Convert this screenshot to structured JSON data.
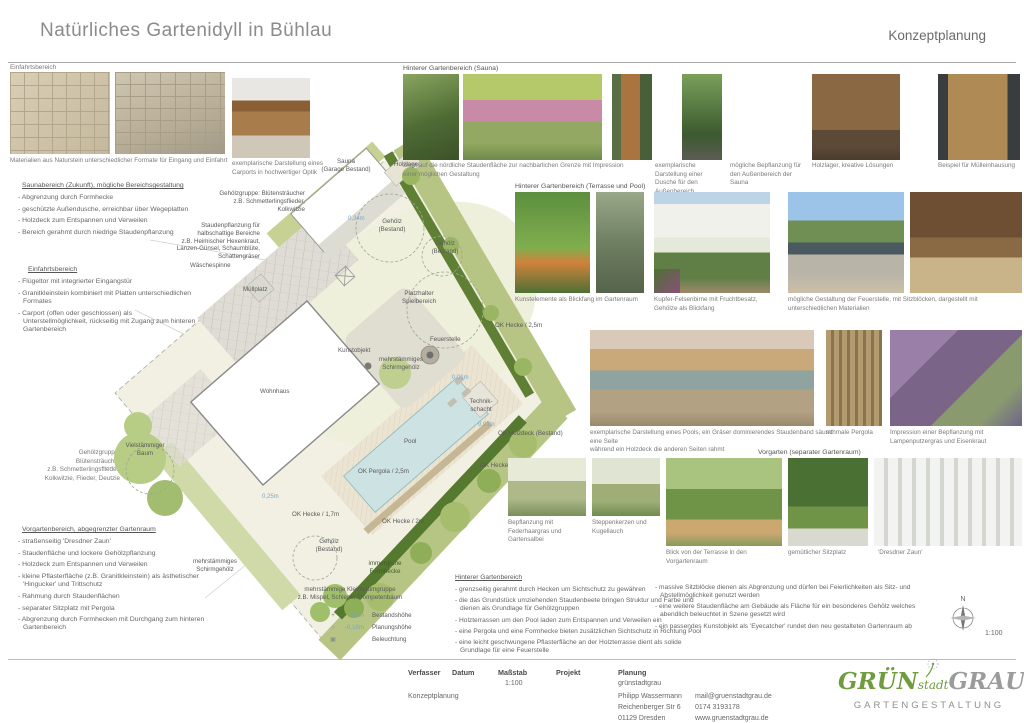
{
  "header": {
    "title": "Natürliches Gartenidyll in Bühlau",
    "doc_type": "Konzeptplanung"
  },
  "left": {
    "einfahrt_label": "Einfahrtsbereich",
    "einfahrt_caption": "Materialien aus Naturstein unterschiedlicher Formate für Eingang und Einfahrt",
    "carport_caption": "exemplarische Darstellung eines Carports in hochwertiger Optik",
    "sauna_heading": "Saunabereich (Zukunft), mögliche Bereichsgestaltung",
    "sauna_items": [
      "- Abgrenzung durch Formhecke",
      "- geschützte Außendusche, erreichbar über Wegeplatten",
      "- Holzdeck zum Entspannen und Verweilen",
      "- Bereich gerahmt durch niedrige Staudenpflanzung"
    ],
    "einfahrt_heading": "Einfahrtsbereich",
    "einfahrt_items": [
      "- Flügeltor mit integrierter Eingangstür",
      "- Granitkleinstein kombiniert mit Platten unterschiedlichen Formates",
      "- Carport (offen oder geschlossen) als Unterstellmöglichkeit, rückseitig mit Zugang zum hinteren Gartenbereich"
    ],
    "gehoelz_note": "Gehölzgruppe: Blütensträucher\nz.B. Schmetterlingsflieder,\nKolkwitzie, Flieder, Deutzie",
    "vorgarten_heading": "Vorgartenbereich, abgegrenzter Gartenraum",
    "vorgarten_items": [
      "- straßenseitig 'Dresdner Zaun'",
      "- Staudenfläche und lockere Gehölzpflanzung",
      "- Holzdeck zum Entspannen und Verweilen",
      "- kleine Pflasterfläche (z.B. Granitkleinstein) als ästhetischer 'Hingucker' und Trittschutz",
      "- Rahmung durch Staudenflächen",
      "- separater Sitzplatz mit Pergola",
      "- Abgrenzung durch Formhecken mit Durchgang zum hinteren Gartenbereich"
    ]
  },
  "plan": {
    "labels": {
      "sauna": "Sauna\n(Garage Bestand)",
      "holzlager": "Holzlager",
      "gehoelzgruppe": "Gehölzgruppe: Blütensträucher\nz.B. Schmetterlingsflieder,\nKolkwitzie",
      "stauden": "Staudenpflanzung für\nhalbschattige Bereiche\nz.B. Heimischer Hexenkraut,\nLanzen-Günsel, Schaumblüte,\nSchattengräser",
      "waeschespinne": "Wäschespinne",
      "gehoelz_bestand": "Gehölz\n(Bestand)",
      "muellplatz": "Müllplatz",
      "spielbereich": "Platzhalter\nSpielbereich",
      "ok_hecke_25": "OK Hecke / 2,5m",
      "feuerstelle": "Feuerstelle",
      "kunstobjekt": "Kunstobjekt",
      "schirmgehoelz": "mehrstämmiges\nSchirmgehölz",
      "wohnhaus": "Wohnhaus",
      "technikschacht": "Technik-\nschacht",
      "holzdeck": "OK Holzdeck (Bestand)",
      "pool": "Pool",
      "ok_pergola": "OK Pergola / 2,5m",
      "ok_hecke_2": "OK Hecke / 2m",
      "ok_hecke_17": "OK Hecke / 1,7m",
      "vielstaemmig": "Vielstämmiger\nBaum",
      "immergruen": "immergrüne\nFormhecke",
      "kleinbaum": "mehrstämmige Kleinbaumgruppe\nz.B. Mispel, Schlehe, Trompetenbaum",
      "h_034": "0,34m",
      "h_001": "0,01m",
      "h_025": "0,25m"
    },
    "legend": [
      {
        "sym": "+",
        "value": "0,0m",
        "label": "Bestandshöhe"
      },
      {
        "sym": "○",
        "value": "-0,18m",
        "label": "Planungshöhe"
      },
      {
        "sym": "▣",
        "value": "",
        "label": "Beleuchtung"
      }
    ],
    "north_label": "N",
    "scale": "1:100"
  },
  "photos": {
    "sections": [
      {
        "heading": "Hinterer Gartenbereich (Sauna)",
        "captions": [
          "Sicht auf die nördliche Staudenfläche zur nachbarlichen Grenze mit Impression einer möglichen Gestaltung",
          "exemplarische Darstellung einer Dusche für den Außenbereich",
          "mögliche Bepflanzung für den Außenbereich der Sauna",
          "Holzlager, kreative Lösungen",
          "Beispiel für Mülleinhausung"
        ]
      },
      {
        "heading": "Hinterer Gartenbereich (Terrasse und Pool)",
        "captions": [
          "Kunstelemente als Blickfang im Gartenraum",
          "Kupfer-Felsenbirne mit Fruchtbesatz,\nGehölze als Blickfang",
          "mögliche Gestaltung der Feuerstelle, mit Sitzblöcken, dargestellt mit unterschiedlichen Materialien",
          "exemplarische Darstellung eines Pools, ein Gräser dominierendes Staudenband säumt eine Seite\nwährend ein Holzdeck die anderen Seiten rahmt",
          "schmale Pergola",
          "Impression einer Bepflanzung mit Lampenputzergras und Eisenkraut"
        ]
      },
      {
        "heading": "Vorgarten (separater Gartenraum)",
        "captions": [
          "Bepflanzung mit Federhaargras und Gartensalbei",
          "Steppenkerzen und Kugellauch",
          "Blick von der Terrasse in den Vorgartenraum",
          "gemütlicher Sitzplatz",
          "'Dresdner Zaun'"
        ]
      }
    ]
  },
  "notes": {
    "heading": "Hinterer Gartenbereich",
    "col1": [
      "- grenzseitig gerahmt durch Hecken um Sichtschutz zu gewähren",
      "- die das Grundstück umziehenden Staudenbeete bringen Struktur und Farbe und dienen als Grundlage für Gehölzgruppen",
      "- Holzterrassen um den Pool laden zum Entspannen und Verweilen ein",
      "- eine Pergola und eine Formhecke bieten zusätzlichen Sichtschutz in Richtung Pool",
      "- eine leicht geschwungene Pflasterfläche an der Holzterrasse dient als solide Grundlage für eine Feuerstelle"
    ],
    "col2": [
      "- massive Sitzblöcke dienen als Abgrenzung und dürfen bei Feierlichkeiten als Sitz- und Abstellmöglichkeit genutzt werden",
      "- eine weitere Staudenfläche am Gebäude als Fläche für ein besonderes Gehölz welches abendlich beleuchtet in Szene gesetzt wird",
      "- ein passendes Kunstobjekt als 'Eyecatcher' rundet den neu gestalteten Gartenraum ab"
    ]
  },
  "titleblock": {
    "headers": [
      "Verfasser",
      "Datum",
      "Maßstab",
      "Projekt",
      "Planung"
    ],
    "verfasser_value": "Konzeptplanung",
    "massstab_value": "1:100",
    "firm": "grünstadtgrau",
    "contact_name": "Philipp Wassermann",
    "street": "Reichenberger Str 6",
    "city": "01129 Dresden",
    "email": "mail@gruenstadtgrau.de",
    "phone": "0174 3193178",
    "web": "www.gruenstadtgrau.de"
  },
  "logo": {
    "part1": "GRÜN",
    "part2": "stadt",
    "part3": "GRAU",
    "subtitle": "GARTENGESTALTUNG",
    "green": "#6f9c3e",
    "gray": "#9b9b9b"
  }
}
